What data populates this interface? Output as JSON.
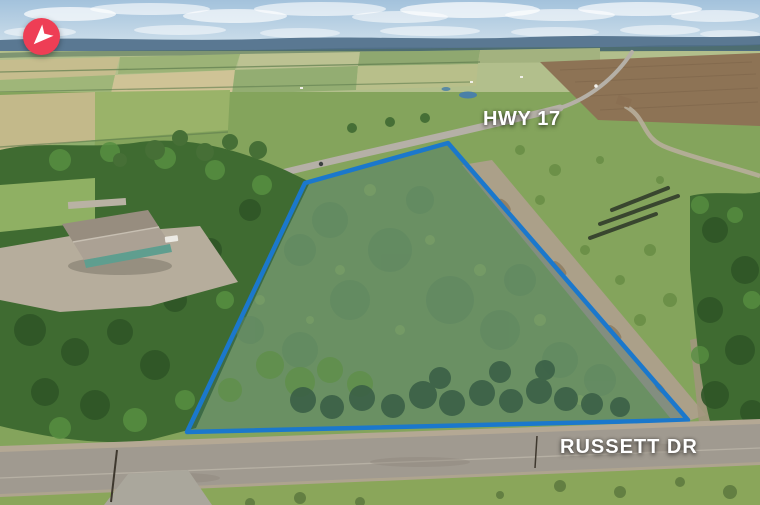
{
  "scene": {
    "alt": "Aerial drone view of a treed vacant lot outlined in blue, bounded by Russett Dr in front and Hwy 17 behind"
  },
  "labels": {
    "highway": "HWY 17",
    "street": "RUSSETT DR"
  },
  "property": {
    "outline_points": "305,183 448,143 688,420 187,432",
    "outline_color": "#1b78cc",
    "stroke_width": "4.5",
    "fill_tint": "rgba(58,108,112,0.35)"
  },
  "compass": {
    "icon": "navigation-arrow-icon",
    "bg_color": "#ee3e55",
    "arrow_color": "#ffffff"
  },
  "colors": {
    "sky_top": "#a3c2dc",
    "sky_bottom": "#dde9f0",
    "hills": "#5a7892",
    "far_fields": "#b2bf8c",
    "meadow": "#84a45c",
    "forest": "#3f6b31",
    "conifer": "#3a5f46",
    "plowed_field": "#8d7355",
    "asphalt_road": "#a09a90",
    "gravel": "#b4a894",
    "label_text": "#ffffff"
  }
}
